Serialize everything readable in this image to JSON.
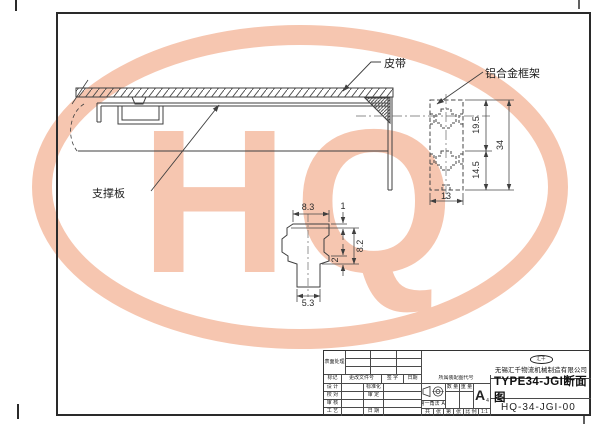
{
  "watermark": {
    "text": "HQ",
    "color": "#f6c6b0"
  },
  "drawing": {
    "labels": {
      "belt": "皮带",
      "alu_frame": "铝合金框架",
      "support_plate": "支撑板"
    },
    "profile_dims": {
      "upper": "19.5",
      "lower": "14.5",
      "total": "34",
      "width": "13"
    },
    "detail_dims": {
      "top_width": "8.3",
      "bar_th": "1",
      "head_h": "8.2",
      "lip": "2",
      "stem_w": "5.3"
    }
  },
  "title_block": {
    "surface": "表面处理",
    "header": {
      "mark": "标记",
      "change_doc": "更改文件号",
      "sign": "签 字",
      "date": "日期"
    },
    "rows": [
      {
        "label": "设 计",
        "mid": "标准化"
      },
      {
        "label": "校 对",
        "mid": "审 定"
      },
      {
        "label": "审 核",
        "mid": ""
      },
      {
        "label": "工 艺",
        "mid": "日 期"
      }
    ],
    "belongs": "所属装配图代号",
    "qty": "数 量",
    "weight": "重 量",
    "projection": "第一角法",
    "sheet_size": "A4",
    "rev": "A",
    "rev_sub": "4",
    "total_label": "共",
    "sheet_label": "张",
    "page_label": "第",
    "page_sheet_label": "张",
    "scale_label": "比 例",
    "scale_value": "1:1",
    "logo": "汇千",
    "company": "无锡汇千物流机械制造有限公司",
    "title": "TYPE34-JGI断面图",
    "drawing_no": "HQ-34-JGI-00"
  }
}
